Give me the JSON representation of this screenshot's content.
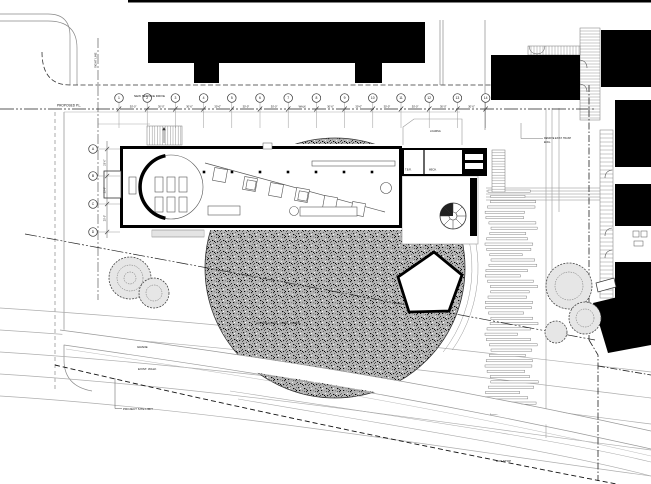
{
  "colors": {
    "ink": "#000000",
    "background": "#ffffff",
    "hatch_base": "#b5b5b5",
    "medium_line": "#555555",
    "light_line": "#999999"
  },
  "labels": {
    "proposed_pl": "PROPOSED P.L.",
    "new_service_drive": "NEW SERVICE DRIVE",
    "sight_line": "SIGHT LINE",
    "loading": "LOADING",
    "remove_note_line1": "REMOVE EXIST. TRASH",
    "remove_note_line2": "ENCL.",
    "room_tbr": "T.B.R.",
    "room_mech": "MECH.",
    "paving_note": "EXPOSED AGG. CONC. PAVING",
    "grade": "GRADE",
    "exist_walk": "EXIST. WALK",
    "project_site_limit": "PROJECT SITE LIMIT",
    "bus_stop": "BUS STOP"
  },
  "grid": {
    "columns": [
      "1",
      "2",
      "3",
      "4",
      "5",
      "6",
      "7",
      "8",
      "9",
      "10",
      "11",
      "12",
      "13",
      "14"
    ],
    "bay_labels": [
      "30'-0\"",
      "30'-0\"",
      "30'-0\"",
      "30'-0\"",
      "30'-0\"",
      "30'-0\"",
      "WALK",
      "30'-0\"",
      "30'-0\"",
      "30'-0\"",
      "30'-0\"",
      "30'-0\"",
      "30'-0\""
    ],
    "rows": [
      "A",
      "B",
      "C",
      "D"
    ],
    "row_bay_labels": [
      "25'-0\"",
      "25'-0\"",
      "25'-0\""
    ]
  }
}
